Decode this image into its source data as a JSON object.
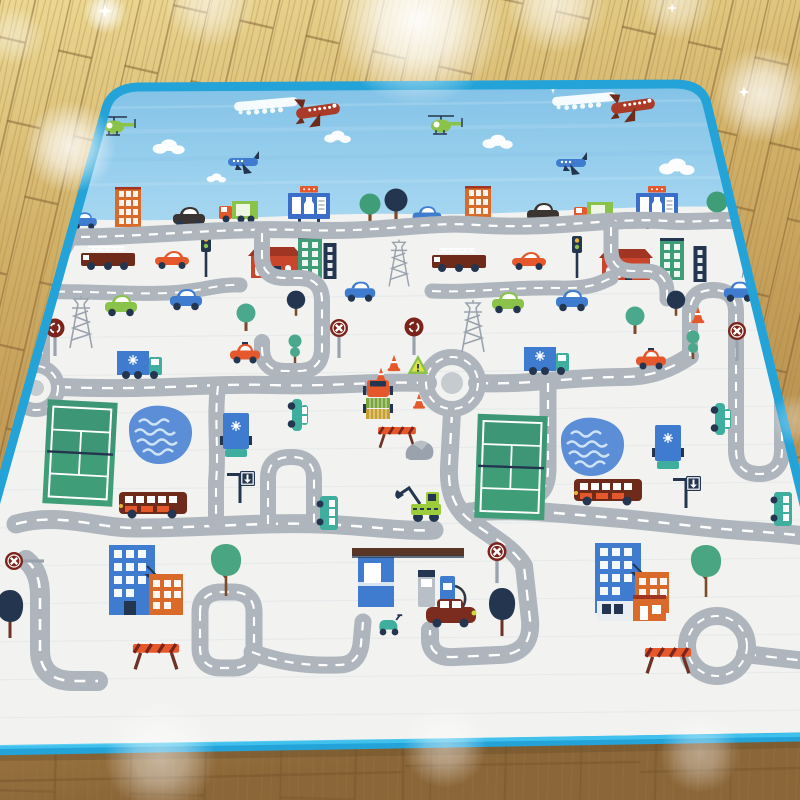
{
  "scene": {
    "description": "Product photo: children's city-road play mat with blue border lying on a wooden parquet floor with light flares",
    "palette": {
      "floor1": "#ecd892",
      "floor2": "#d2b168",
      "floor3": "#c19a55",
      "floor4": "#8f6a3a",
      "gap": "#7b5a2e",
      "grain": "#9c7c44",
      "border": "#24a3d8",
      "border2": "#45c6f0",
      "sky1": "#7fc0e6",
      "sky2": "#a6d7f1",
      "mat": "#f2f3f1",
      "streak": "#d9dfe4",
      "road": "#aeb5bc",
      "dash": "#ffffff",
      "island": "#c6cbd0",
      "white": "#ffffff",
      "rust": "#a93b28",
      "maroon": "#6f2b1a",
      "darkred": "#7c241c",
      "red": "#c9452c",
      "redroof": "#a03524",
      "orange": "#e4582c",
      "orangeb": "#d96a2a",
      "lime": "#8bc34a",
      "lime2": "#9ccc3b",
      "olive": "#7aa63c",
      "mustard": "#c8a02e",
      "green": "#3f9e78",
      "green2": "#358a66",
      "green3": "#4aa583",
      "tealgr": "#4aa98c",
      "teal": "#3fae9e",
      "blue": "#3f7cd0",
      "blue2": "#3b6ec8",
      "navy": "#24364f",
      "pond": "#5b8ed6",
      "wave": "#cfe3f7",
      "metal": "#9aa3ad",
      "metal2": "#b8bfc6",
      "yellow": "#e8b33c",
      "carblack": "#3a3432",
      "vanred": "#7c2c1e",
      "brownk": "#5a3626",
      "trunk": "#7a4a2a",
      "trunkm": "#6e3226",
      "shopwhite": "#e9eef3"
    },
    "roads": [
      {
        "d": "M 30,236 C 120,241 205,227 300,230 C 385,233 425,221 478,225 C 552,230 612,217 668,221 C 696,223 718,219 736,221",
        "w": 17
      },
      {
        "d": "M 70,234 C 66,256 44,262 42,286 L 42,362",
        "w": 16
      },
      {
        "d": "M 22,293 C 70,289 120,295 168,293 C 200,292 216,284 240,285",
        "w": 15
      },
      {
        "d": "M 432,291 C 470,293 512,287 560,288 C 592,289 602,282 611,278",
        "w": 15
      },
      {
        "d": "M 262,233 L 262,256 C 262,271 270,278 285,278 L 299,278 C 314,278 322,286 322,301 L 322,348 C 322,363 314,371 299,371 L 285,371 C 270,371 262,363 262,348 L 262,342",
        "w": 16
      },
      {
        "d": "M 611,227 L 611,250 C 611,264 619,271 633,271 L 645,271 C 660,271 667,279 667,293 L 667,299",
        "w": 15
      },
      {
        "d": "M 60,387 C 150,391 210,383 270,385 C 330,387 372,381 428,383",
        "w": 18
      },
      {
        "d": "M 477,383 C 530,385 572,377 622,377 C 652,377 672,368 690,356",
        "w": 18
      },
      {
        "d": "M 690,356 L 690,312 C 690,297 698,290 713,290 C 728,290 736,297 736,312 L 736,450 C 736,466 744,474 759,474 C 774,474 782,466 782,450 L 782,398",
        "w": 16
      },
      {
        "d": "M 548,383 L 548,468 C 548,490 540,498 520,500 C 500,502 484,508 470,512",
        "w": 17
      },
      {
        "d": "M 16,524 C 60,512 95,528 135,528 C 200,528 262,522 320,524 C 370,526 406,532 434,530",
        "w": 19
      },
      {
        "d": "M 470,512 C 520,508 562,514 616,518 C 662,522 704,528 748,531 C 768,532 786,534 806,536",
        "w": 19
      },
      {
        "d": "M 218,386 C 214,420 219,450 216,482 L 216,522",
        "w": 16
      },
      {
        "d": "M 268,524 L 268,478 C 268,464 276,457 290,457 L 292,457 C 306,457 314,464 314,478 L 314,524",
        "w": 16
      },
      {
        "d": "M 26,560 C 36,568 40,580 40,596 L 40,650 C 40,671 52,681 74,681 L 98,681",
        "w": 20
      },
      {
        "d": "M 200,612 L 200,648 C 200,661 208,668 221,668 L 233,668 C 246,668 254,661 254,648 L 254,612 C 254,599 246,592 233,592 L 221,592 C 208,592 200,599 200,612 Z",
        "w": 17
      },
      {
        "d": "M 252,652 C 280,663 310,666 338,665 C 352,665 359,658 361,644 L 363,622",
        "w": 17
      },
      {
        "d": "M 452,412 L 449,468 C 448,494 456,510 472,522 C 492,537 514,548 524,566 L 530,620 C 532,644 520,655 498,655 L 454,657 C 438,658 430,651 430,639 L 430,630",
        "w": 18
      },
      {
        "d": "M 745,654 L 806,661",
        "w": 18
      }
    ],
    "roundabouts": [
      {
        "x": 36,
        "y": 388,
        "r": 22,
        "w": 14,
        "ir": 8,
        "island": true
      },
      {
        "x": 452,
        "y": 383,
        "r": 26,
        "w": 16,
        "ir": 11,
        "island": true
      },
      {
        "x": 717,
        "y": 646,
        "r": 30,
        "w": 18,
        "ir": 0,
        "island": false
      }
    ],
    "objects": [
      {
        "t": "heli",
        "x": 114,
        "y": 127
      },
      {
        "t": "heli",
        "x": 441,
        "y": 126
      },
      {
        "t": "contrail",
        "x": 266,
        "y": 104,
        "r": -5
      },
      {
        "t": "red-plane",
        "x": 318,
        "y": 111
      },
      {
        "t": "contrail",
        "x": 584,
        "y": 99,
        "r": -5
      },
      {
        "t": "red-plane",
        "x": 633,
        "y": 106
      },
      {
        "t": "blue-plane",
        "x": 243,
        "y": 162
      },
      {
        "t": "blue-plane",
        "x": 571,
        "y": 163
      },
      {
        "t": "cloud",
        "x": 168,
        "y": 147,
        "s": 0.9
      },
      {
        "t": "cloud",
        "x": 337,
        "y": 137,
        "s": 0.75
      },
      {
        "t": "cloud",
        "x": 497,
        "y": 142,
        "s": 0.85
      },
      {
        "t": "cloud",
        "x": 676,
        "y": 167
      },
      {
        "t": "cloud",
        "x": 216,
        "y": 178,
        "s": 0.55
      },
      {
        "t": "star",
        "x": 553,
        "y": 88,
        "s": 0.8
      },
      {
        "t": "building-orange",
        "x": 128,
        "y": 207,
        "l": "b"
      },
      {
        "t": "building-orange",
        "x": 478,
        "y": 206,
        "l": "b"
      },
      {
        "t": "car-black",
        "x": 189,
        "y": 219,
        "l": "b"
      },
      {
        "t": "car-black",
        "x": 543,
        "y": 215,
        "l": "b"
      },
      {
        "t": "truck-green",
        "x": 239,
        "y": 213,
        "l": "b"
      },
      {
        "t": "truck-green",
        "x": 594,
        "y": 214,
        "l": "b"
      },
      {
        "t": "billboard",
        "x": 309,
        "y": 206,
        "l": "b"
      },
      {
        "t": "billboard",
        "x": 657,
        "y": 206,
        "l": "b"
      },
      {
        "t": "tree-green",
        "x": 370,
        "y": 207,
        "l": "b"
      },
      {
        "t": "tree-green",
        "x": 717,
        "y": 205,
        "l": "b"
      },
      {
        "t": "tree-navy",
        "x": 396,
        "y": 204,
        "l": "b"
      },
      {
        "t": "car-blue",
        "x": 427,
        "y": 217,
        "s": 0.9,
        "l": "b"
      },
      {
        "t": "car-blue",
        "x": 84,
        "y": 222,
        "s": 0.8,
        "l": "b"
      },
      {
        "t": "pylon",
        "x": 399,
        "y": 263,
        "s": 0.9,
        "l": "b"
      },
      {
        "t": "pylon",
        "x": 751,
        "y": 257,
        "s": 0.8,
        "l": "b"
      },
      {
        "t": "firetruck",
        "x": 108,
        "y": 259,
        "l": "b"
      },
      {
        "t": "firetruck",
        "x": 459,
        "y": 261,
        "l": "b"
      },
      {
        "t": "car-orange",
        "x": 172,
        "y": 261,
        "l": "b"
      },
      {
        "t": "car-orange",
        "x": 529,
        "y": 262,
        "l": "b"
      },
      {
        "t": "traffic-light",
        "x": 206,
        "y": 257,
        "l": "b"
      },
      {
        "t": "traffic-light",
        "x": 577,
        "y": 258,
        "l": "b"
      },
      {
        "t": "house-red",
        "x": 275,
        "y": 263,
        "l": "b"
      },
      {
        "t": "house-red",
        "x": 626,
        "y": 265,
        "l": "b"
      },
      {
        "t": "building-green",
        "x": 310,
        "y": 257,
        "l": "b"
      },
      {
        "t": "building-green",
        "x": 672,
        "y": 259,
        "l": "b"
      },
      {
        "t": "building-navy",
        "x": 330,
        "y": 261,
        "l": "b"
      },
      {
        "t": "building-navy",
        "x": 700,
        "y": 264,
        "l": "b"
      },
      {
        "t": "pylon",
        "x": 81,
        "y": 322
      },
      {
        "t": "pylon",
        "x": 473,
        "y": 326
      },
      {
        "t": "car-green",
        "x": 121,
        "y": 307
      },
      {
        "t": "car-green",
        "x": 508,
        "y": 304
      },
      {
        "t": "car-blue",
        "x": 186,
        "y": 301
      },
      {
        "t": "car-blue",
        "x": 572,
        "y": 302
      },
      {
        "t": "car-blue",
        "x": 360,
        "y": 293,
        "s": 0.95
      },
      {
        "t": "car-blue",
        "x": 739,
        "y": 293,
        "s": 0.95
      },
      {
        "t": "tree-teal",
        "x": 246,
        "y": 316
      },
      {
        "t": "tree-teal",
        "x": 635,
        "y": 319
      },
      {
        "t": "tree-navy",
        "x": 296,
        "y": 303,
        "s": 0.8
      },
      {
        "t": "tree-navy",
        "x": 676,
        "y": 303,
        "s": 0.8
      },
      {
        "t": "tree-twoball",
        "x": 295,
        "y": 349
      },
      {
        "t": "tree-twoball",
        "x": 693,
        "y": 345
      },
      {
        "t": "sign-round",
        "x": 55,
        "y": 336
      },
      {
        "t": "sign-round",
        "x": 414,
        "y": 335
      },
      {
        "t": "sign-stop",
        "x": 339,
        "y": 336
      },
      {
        "t": "sign-stop",
        "x": 737,
        "y": 339
      },
      {
        "t": "warn-triangle",
        "x": 418,
        "y": 366
      },
      {
        "t": "cone",
        "x": 394,
        "y": 363,
        "s": 0.9
      },
      {
        "t": "cone",
        "x": 381,
        "y": 375,
        "s": 0.8
      },
      {
        "t": "cone",
        "x": 419,
        "y": 401,
        "s": 0.85
      },
      {
        "t": "cone",
        "x": 698,
        "y": 315,
        "s": 0.9
      },
      {
        "t": "truck-orange-crates",
        "x": 378,
        "y": 404
      },
      {
        "t": "truck-orange-crates",
        "x": 791,
        "y": 399
      },
      {
        "t": "barrier",
        "x": 397,
        "y": 436,
        "s": 0.9
      },
      {
        "t": "rock-gray",
        "x": 420,
        "y": 452
      },
      {
        "t": "truck-blue-h",
        "x": 140,
        "y": 364
      },
      {
        "t": "truck-blue-h",
        "x": 547,
        "y": 360
      },
      {
        "t": "taxi",
        "x": 245,
        "y": 355
      },
      {
        "t": "taxi",
        "x": 651,
        "y": 361
      },
      {
        "t": "truck-blue-v",
        "x": 236,
        "y": 434
      },
      {
        "t": "truck-blue-v",
        "x": 668,
        "y": 446
      },
      {
        "t": "car-teal-wagon",
        "x": 297,
        "y": 415,
        "r": 90
      },
      {
        "t": "car-teal-wagon",
        "x": 720,
        "y": 419,
        "r": 90
      },
      {
        "t": "court",
        "x": 80,
        "y": 453,
        "r": 3
      },
      {
        "t": "court",
        "x": 511,
        "y": 467,
        "r": 2
      },
      {
        "t": "pond",
        "x": 161,
        "y": 436
      },
      {
        "t": "pond",
        "x": 593,
        "y": 448
      },
      {
        "t": "sign-arrow",
        "x": 240,
        "y": 487
      },
      {
        "t": "sign-arrow",
        "x": 686,
        "y": 492
      },
      {
        "t": "excavator",
        "x": 426,
        "y": 504
      },
      {
        "t": "bus-brown",
        "x": 153,
        "y": 503
      },
      {
        "t": "bus-brown",
        "x": 608,
        "y": 490
      },
      {
        "t": "bus-teal",
        "x": 329,
        "y": 513,
        "r": 90
      },
      {
        "t": "bus-teal",
        "x": 783,
        "y": 509,
        "r": 90
      },
      {
        "t": "sign-stop",
        "x": 497,
        "y": 560,
        "s": 1.05
      },
      {
        "t": "sign-stop",
        "x": 22,
        "y": 561,
        "r": -90
      },
      {
        "t": "tree-tall-green",
        "x": 226,
        "y": 570
      },
      {
        "t": "tree-tall-green",
        "x": 706,
        "y": 571
      },
      {
        "t": "bldg-pair",
        "x": 136,
        "y": 580
      },
      {
        "t": "bldg-pair",
        "x": 622,
        "y": 578
      },
      {
        "t": "tree-tall-dark",
        "x": 10,
        "y": 614
      },
      {
        "t": "tree-tall-dark",
        "x": 502,
        "y": 612
      },
      {
        "t": "gas-station",
        "x": 412,
        "y": 588
      },
      {
        "t": "car-darkred-van",
        "x": 451,
        "y": 615
      },
      {
        "t": "scooter",
        "x": 389,
        "y": 626,
        "s": 1.2
      },
      {
        "t": "shops",
        "x": 632,
        "y": 608
      },
      {
        "t": "barrier",
        "x": 156,
        "y": 655,
        "s": 1.1
      },
      {
        "t": "barrier",
        "x": 668,
        "y": 659,
        "s": 1.1
      }
    ],
    "flares": [
      {
        "x": 418,
        "y": 20,
        "r": 86,
        "o": 0.95
      },
      {
        "x": 210,
        "y": 2,
        "r": 46,
        "o": 0.55
      },
      {
        "x": 556,
        "y": 4,
        "r": 50,
        "o": 0.65
      },
      {
        "x": 676,
        "y": 0,
        "r": 40,
        "o": 0.5
      },
      {
        "x": 762,
        "y": 95,
        "r": 48,
        "o": 0.75
      },
      {
        "x": 70,
        "y": 147,
        "r": 46,
        "o": 0.8
      },
      {
        "x": 14,
        "y": 36,
        "r": 30,
        "o": 0.4
      },
      {
        "x": 160,
        "y": 757,
        "r": 56,
        "o": 0.5
      },
      {
        "x": 445,
        "y": 746,
        "r": 42,
        "o": 0.45
      },
      {
        "x": 700,
        "y": 753,
        "r": 40,
        "o": 0.4
      },
      {
        "x": 795,
        "y": 420,
        "r": 26,
        "o": 0.3
      },
      {
        "x": 105,
        "y": 12,
        "r": 22,
        "o": 0.8
      }
    ],
    "sparkles": [
      {
        "x": 105,
        "y": 11,
        "s": 1
      },
      {
        "x": 672,
        "y": 8,
        "s": 0.7
      },
      {
        "x": 744,
        "y": 92,
        "s": 0.8
      }
    ]
  }
}
